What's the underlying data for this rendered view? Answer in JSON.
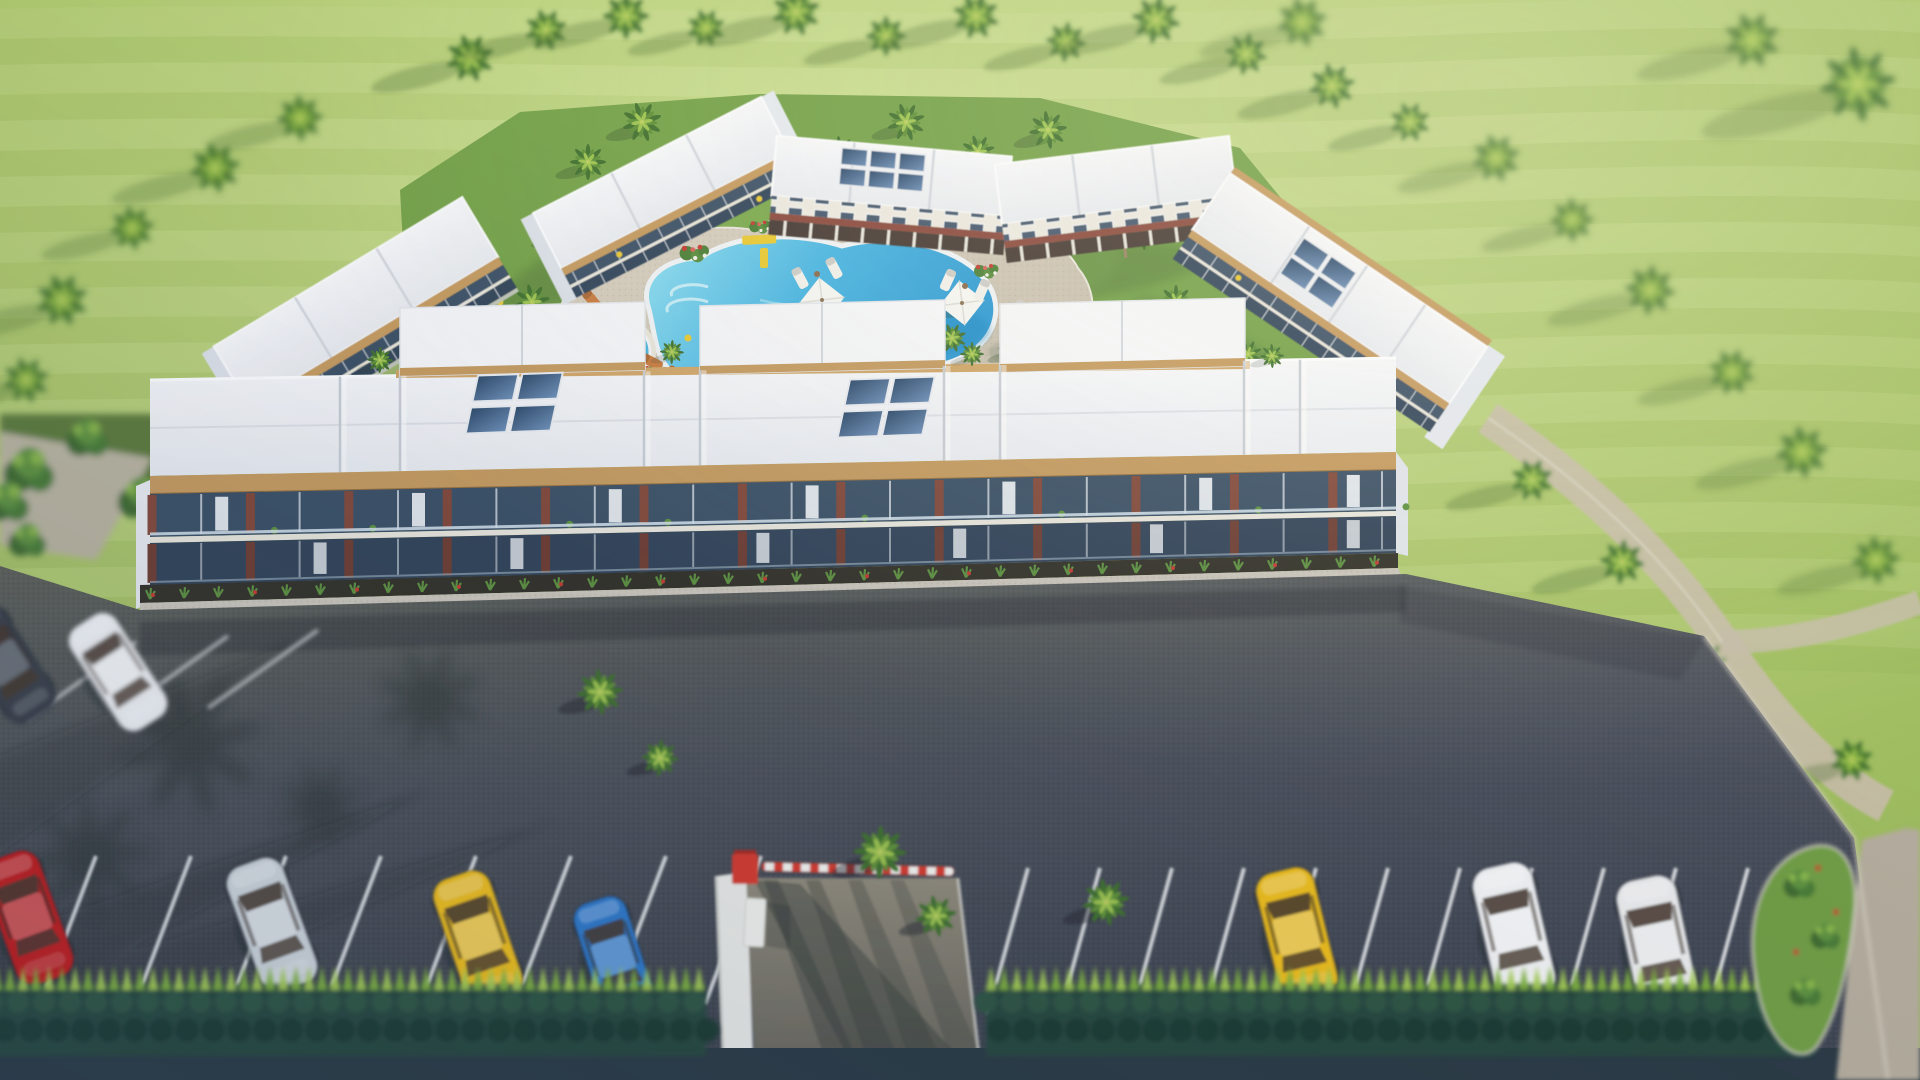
{
  "image": {
    "type": "3d-architectural-render",
    "subject": "aerial view of a tropical apartment-resort complex with courtyard pool, palm trees, lawn and front parking lot",
    "style": "tilt-shift aerial render, warm sunlight from upper right"
  },
  "palette": {
    "grass_light": "#c9dc8e",
    "grass": "#a9c468",
    "grass_dark": "#8fb054",
    "courtyard_lawn": "#74a148",
    "asphalt": "#4d5157",
    "asphalt_dark": "#3e434b",
    "roof_white": "#f2f3f5",
    "roof_ridge": "#c7ccd3",
    "wood_trim": "#c49a5f",
    "wood_trim_light": "#cfa568",
    "facade_glass": "#3c5166",
    "facade_glass_lower": "#334459",
    "brick_pillar": "#82493b",
    "sidewalk": "#c9c4ba",
    "deck": "#cdc4b3",
    "pool_shallow": "#8fdef0",
    "pool_deep": "#2f9ad2",
    "pool_coping": "#eef1f3",
    "jacuzzi": "#4cb2da",
    "solar_panel": "#3d5878",
    "palm_dark": "#41702f",
    "palm_mid": "#5f9038",
    "palm_light": "#9cc250",
    "hedge_light": "#7fb23e",
    "hedge_dark": "#27473c",
    "street": "#2b3a44",
    "driveway": "#8a8576",
    "gate_wall": "#e9eae6",
    "barrier_red": "#d43b2f",
    "barrier_white": "#f2f2ee",
    "umbrella": "#f4f4f1",
    "lounger_wood": "#c87b3e",
    "bench_yellow": "#e8c832",
    "flower_red": "#c23b32",
    "flower_white": "#efeee4",
    "path": "#c6bda9",
    "stripe": "#e8eaec"
  },
  "parking": {
    "stripe_color": "#e8eaec",
    "left_row_cars": [
      {
        "name": "red-car",
        "color": "#c01d1d",
        "x": 28,
        "y": 918,
        "rot": -20,
        "s": 1.75
      },
      {
        "name": "silver-car",
        "color": "#ced5da",
        "x": 272,
        "y": 925,
        "rot": -20,
        "s": 1.75
      },
      {
        "name": "yellow-car",
        "color": "#edbd1c",
        "x": 478,
        "y": 938,
        "rot": -19,
        "s": 1.75
      },
      {
        "name": "blue-car",
        "color": "#2e78c8",
        "x": 614,
        "y": 958,
        "rot": -18,
        "s": 1.6
      }
    ],
    "right_row_cars": [
      {
        "name": "yellow-car",
        "color": "#edbd1c",
        "x": 1297,
        "y": 935,
        "rot": -14,
        "s": 1.75
      },
      {
        "name": "white-car",
        "color": "#f1f2f3",
        "x": 1514,
        "y": 932,
        "rot": -13,
        "s": 1.8
      },
      {
        "name": "white-car",
        "color": "#e9eaeb",
        "x": 1657,
        "y": 945,
        "rot": -12,
        "s": 1.8
      }
    ],
    "upper_cars": [
      {
        "name": "white-car",
        "color": "#eef0f2",
        "x": 118,
        "y": 672,
        "rot": -33,
        "s": 1.6
      },
      {
        "name": "dark-car",
        "color": "#3a4148",
        "x": 6,
        "y": 664,
        "rot": -33,
        "s": 1.6
      }
    ]
  },
  "pool": {
    "umbrellas": [
      [
        822,
        300
      ],
      [
        962,
        303
      ],
      [
        764,
        397
      ],
      [
        944,
        399
      ]
    ],
    "jacuzzi_center": [
      622,
      352
    ]
  },
  "gate": {
    "wall_color": "#e9eae6",
    "barrier_colors": [
      "#d43b2f",
      "#f2f2ee"
    ]
  },
  "scene": {
    "palms": {
      "far": [
        [
          300,
          118,
          1.15
        ],
        [
          215,
          168,
          1.25
        ],
        [
          132,
          228,
          1.1
        ],
        [
          62,
          300,
          1.3
        ],
        [
          26,
          380,
          1.15
        ],
        [
          1496,
          158,
          1.2
        ],
        [
          1572,
          220,
          1.1
        ],
        [
          1650,
          290,
          1.25
        ],
        [
          1732,
          372,
          1.15
        ],
        [
          1802,
          452,
          1.3
        ],
        [
          1858,
          84,
          1.9
        ],
        [
          1752,
          40,
          1.4
        ],
        [
          1302,
          22,
          1.25
        ],
        [
          1876,
          560,
          1.2
        ]
      ],
      "mid": [
        [
          470,
          58,
          1.2
        ],
        [
          546,
          30,
          1.05
        ],
        [
          626,
          16,
          1.15
        ],
        [
          706,
          28,
          0.95
        ],
        [
          796,
          12,
          1.2
        ],
        [
          886,
          36,
          1.0
        ],
        [
          976,
          16,
          1.15
        ],
        [
          1066,
          42,
          1.0
        ],
        [
          1156,
          20,
          1.2
        ],
        [
          1246,
          54,
          1.05
        ],
        [
          1332,
          86,
          1.15
        ],
        [
          1410,
          122,
          1.0
        ],
        [
          1532,
          480,
          1.05
        ],
        [
          1622,
          562,
          1.1
        ],
        [
          1706,
          662,
          1.0
        ],
        [
          1852,
          760,
          1.05
        ]
      ],
      "near": [
        [
          588,
          162,
          0.9
        ],
        [
          642,
          122,
          1.0
        ],
        [
          702,
          152,
          0.85
        ],
        [
          762,
          116,
          0.95
        ],
        [
          840,
          152,
          0.8
        ],
        [
          906,
          122,
          0.95
        ],
        [
          978,
          152,
          0.85
        ],
        [
          1048,
          130,
          0.95
        ],
        [
          1118,
          166,
          0.9
        ],
        [
          562,
          232,
          0.85
        ],
        [
          532,
          302,
          0.9
        ],
        [
          1142,
          232,
          0.9
        ],
        [
          1176,
          302,
          0.85
        ],
        [
          612,
          332,
          0.7
        ],
        [
          1082,
          362,
          0.8
        ],
        [
          1132,
          402,
          0.75
        ],
        [
          652,
          396,
          0.7
        ],
        [
          432,
          334,
          0.75
        ],
        [
          492,
          346,
          0.7
        ],
        [
          730,
          332,
          0.72
        ],
        [
          772,
          346,
          0.68
        ],
        [
          952,
          338,
          0.72
        ],
        [
          1012,
          350,
          0.68
        ],
        [
          1186,
          344,
          0.75
        ],
        [
          1248,
          354,
          0.7
        ]
      ],
      "gate": [
        [
          600,
          692,
          1.15
        ],
        [
          660,
          758,
          0.92
        ],
        [
          880,
          852,
          1.32
        ],
        [
          936,
          916,
          1.02
        ],
        [
          1106,
          902,
          1.18
        ]
      ],
      "gaps": [
        [
          380,
          360,
          0.65
        ],
        [
          672,
          352,
          0.6
        ],
        [
          972,
          354,
          0.6
        ],
        [
          1272,
          356,
          0.6
        ]
      ]
    },
    "counts": {
      "buildings": 6,
      "pool_umbrellas": 4,
      "cars_visible": 9
    }
  }
}
